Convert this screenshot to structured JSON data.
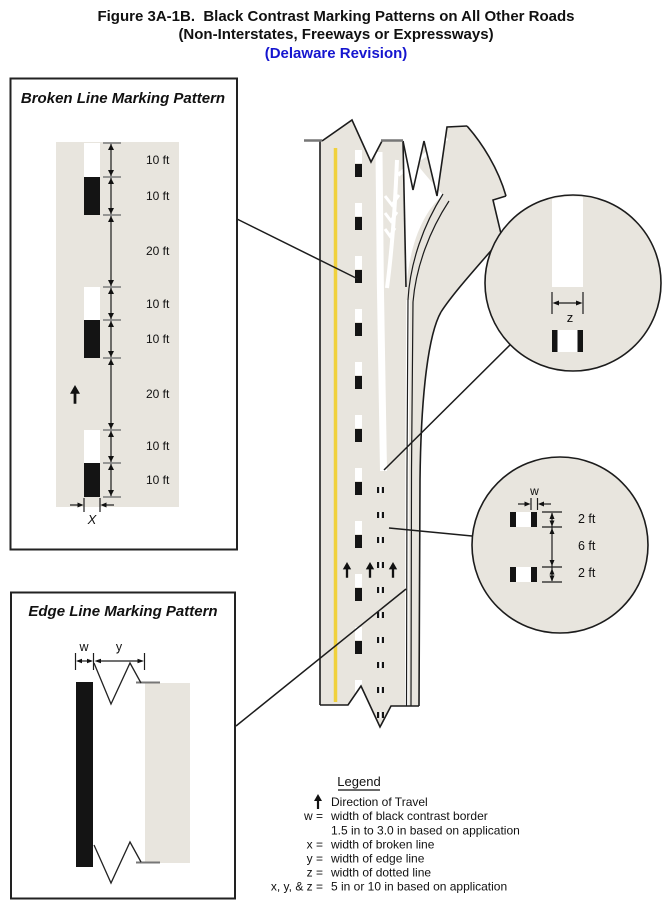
{
  "title": {
    "line1": "Figure 3A-1B.  Black Contrast Marking Patterns on All Other Roads",
    "line2": "(Non-Interstates, Freeways or Expressways)",
    "line3": "(Delaware Revision)"
  },
  "broken_line_box": {
    "title": "Broken Line Marking Pattern",
    "segments": [
      {
        "label": "10 ft"
      },
      {
        "label": "10 ft"
      },
      {
        "label": "20 ft"
      },
      {
        "label": "10 ft"
      },
      {
        "label": "10 ft"
      },
      {
        "label": "20 ft"
      },
      {
        "label": "10 ft"
      },
      {
        "label": "10 ft"
      }
    ],
    "width_label": "X"
  },
  "edge_line_box": {
    "title": "Edge Line Marking Pattern",
    "contrast_width_label": "w",
    "edge_width_label": "y"
  },
  "upper_callout": {
    "dotted_width_label": "z"
  },
  "lower_callout": {
    "contrast_width_label": "w",
    "segment_labels": [
      "2 ft",
      "6 ft",
      "2 ft"
    ]
  },
  "legend": {
    "title": "Legend",
    "entries": [
      {
        "symbol": "",
        "icon": "up-arrow",
        "text": "Direction of Travel"
      },
      {
        "symbol": "w =",
        "text": "width of black contrast border"
      },
      {
        "symbol": "",
        "text": "1.5 in to 3.0 in based on application"
      },
      {
        "symbol": "x =",
        "text": "width of broken line"
      },
      {
        "symbol": "y =",
        "text": "width of edge line"
      },
      {
        "symbol": "z =",
        "text": "width of dotted line"
      },
      {
        "symbol": "x, y, & z =",
        "text": "5 in or 10 in based on application"
      }
    ]
  },
  "colors": {
    "pavement": "#e8e5de",
    "line_dark": "#1c1c1c",
    "yellow_edge_line": "#f0d13c",
    "white_marking": "#ffffff",
    "black_marking": "#141414",
    "revision_blue": "#1515cf"
  }
}
